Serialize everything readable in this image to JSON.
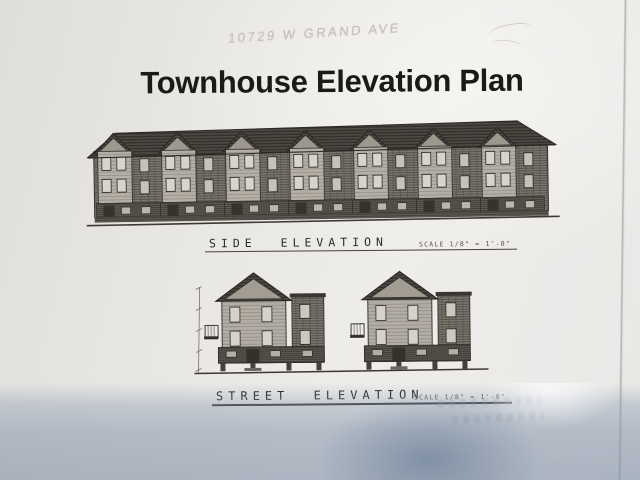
{
  "document": {
    "handwritten_note": "10729 W GRAND AVE",
    "title": "Townhouse Elevation Plan",
    "side_elevation": {
      "label": "SIDE ELEVATION",
      "scale_note": "SCALE 1/8\" = 1'-0\""
    },
    "street_elevation": {
      "label": "STREET ELEVATION",
      "scale_note": "SCALE 1/8\" = 1'-0\""
    }
  },
  "colors": {
    "paper": "#eae8e4",
    "drawing_ink": "#2b2926",
    "title_ink": "#1b1a18",
    "pencil": "#c6c1ba",
    "camera_shadow_blue": "#8298b4"
  }
}
